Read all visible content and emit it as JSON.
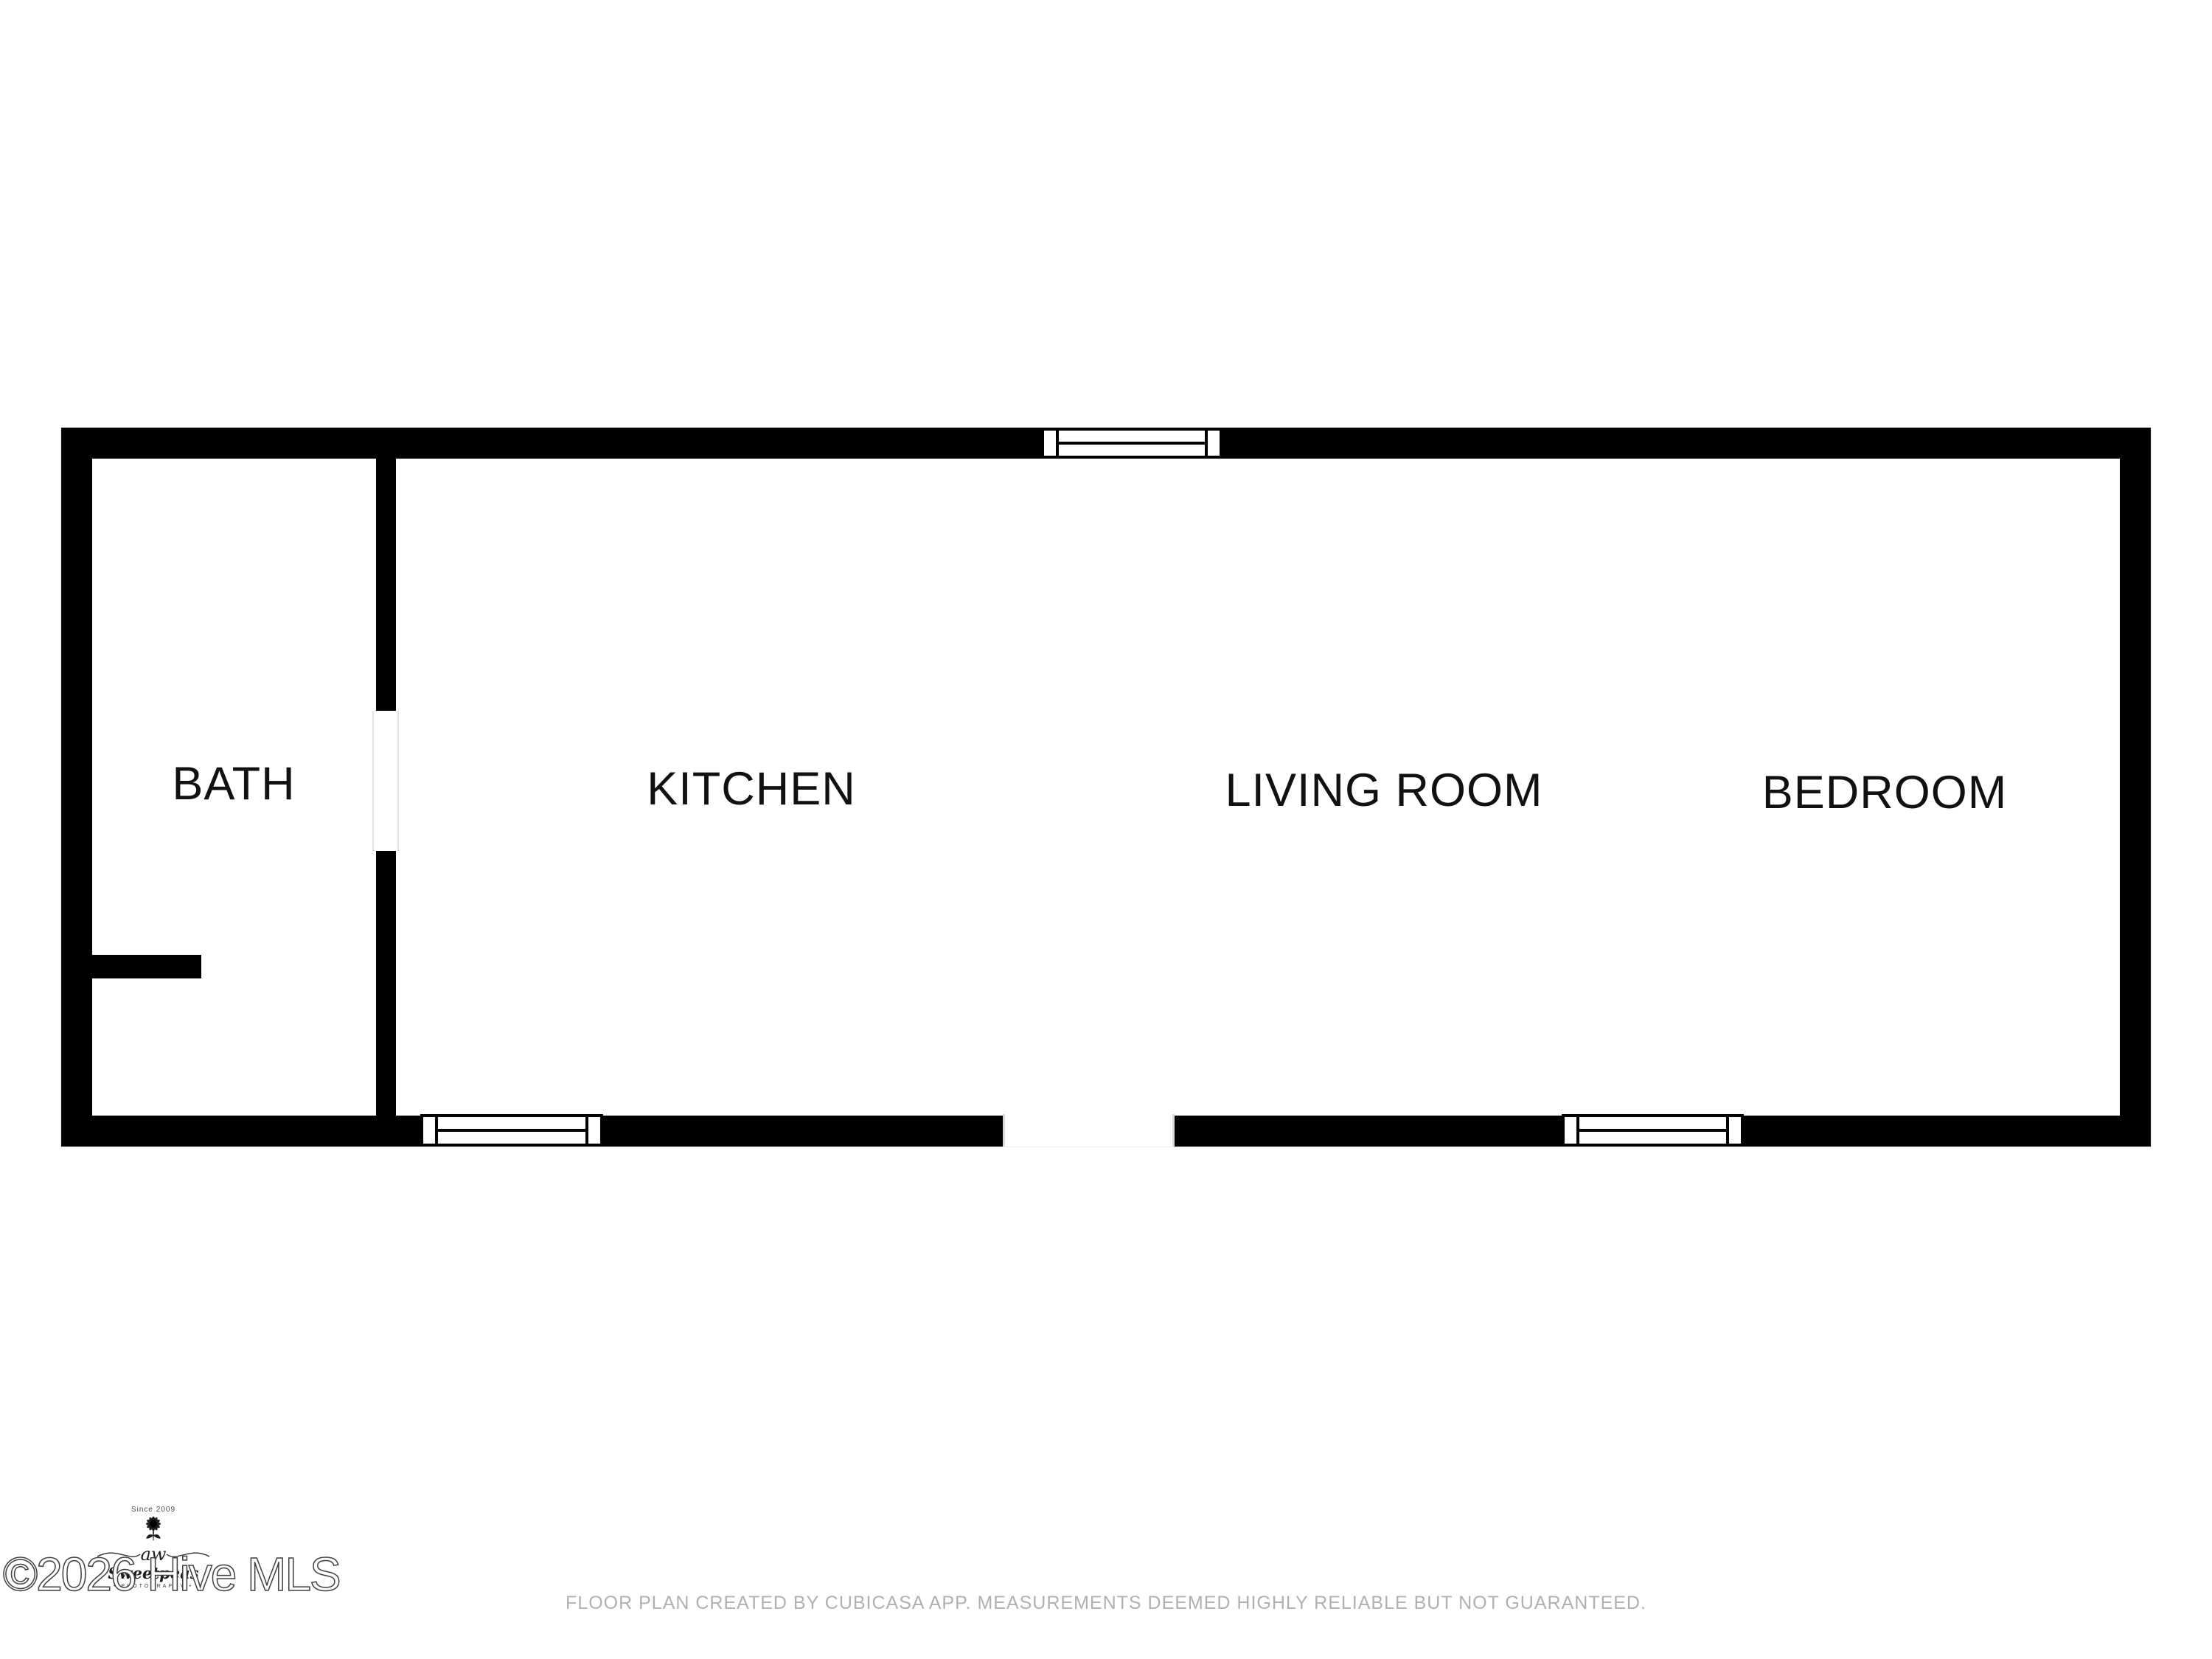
{
  "page": {
    "background_color": "#ffffff"
  },
  "floor_plan": {
    "wall_color": "#000000",
    "label_color": "#111111",
    "rooms": [
      {
        "id": "bath",
        "label": "BATH"
      },
      {
        "id": "kitchen",
        "label": "KITCHEN"
      },
      {
        "id": "living-room",
        "label": "LIVING ROOM"
      },
      {
        "id": "bedroom",
        "label": "BEDROOM"
      }
    ]
  },
  "watermark": {
    "color": "#3f3f3f",
    "copyright_text": "©2026 Hive MLS",
    "logo": {
      "icon": "sunflower-icon",
      "since_text": "Since 2009",
      "initials": "aw",
      "name": "Sweetpeas",
      "subtitle": "• PHOTOGRAPHY •"
    }
  },
  "footer": {
    "color": "#b0b0b0",
    "disclaimer": "FLOOR PLAN CREATED BY CUBICASA APP. MEASUREMENTS DEEMED HIGHLY RELIABLE BUT NOT GUARANTEED."
  }
}
